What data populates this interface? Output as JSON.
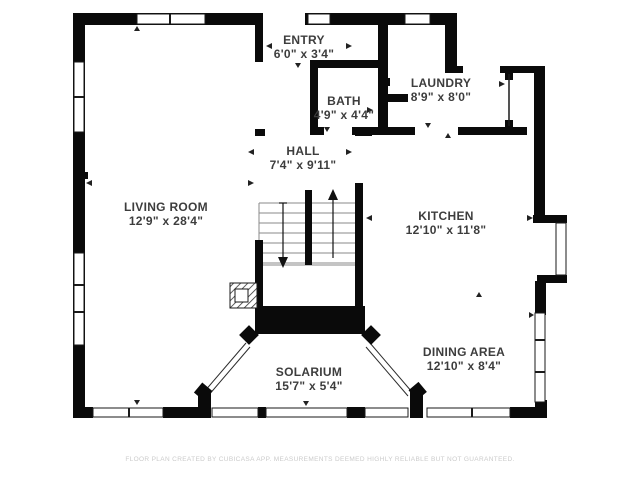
{
  "canvas": {
    "background_color": "#ffffff",
    "wall_color": "#0a0a0a",
    "label_color": "#3d3d3d",
    "disclaimer_color": "#cbcbcb"
  },
  "rooms": [
    {
      "id": "entry",
      "name": "ENTRY",
      "dimensions": "6'0\" x 3'4\""
    },
    {
      "id": "bath",
      "name": "BATH",
      "dimensions": "4'9\" x 4'4\""
    },
    {
      "id": "laundry",
      "name": "LAUNDRY",
      "dimensions": "8'9\" x 8'0\""
    },
    {
      "id": "hall",
      "name": "HALL",
      "dimensions": "7'4\" x 9'11\""
    },
    {
      "id": "living-room",
      "name": "LIVING ROOM",
      "dimensions": "12'9\" x 28'4\""
    },
    {
      "id": "kitchen",
      "name": "KITCHEN",
      "dimensions": "12'10\" x 11'8\""
    },
    {
      "id": "dining-area",
      "name": "DINING AREA",
      "dimensions": "12'10\" x 8'4\""
    },
    {
      "id": "solarium",
      "name": "SOLARIUM",
      "dimensions": "15'7\" x 5'4\""
    }
  ],
  "footer": {
    "disclaimer": "FLOOR PLAN CREATED BY CUBICASA APP. MEASUREMENTS DEEMED HIGHLY RELIABLE BUT NOT GUARANTEED."
  }
}
